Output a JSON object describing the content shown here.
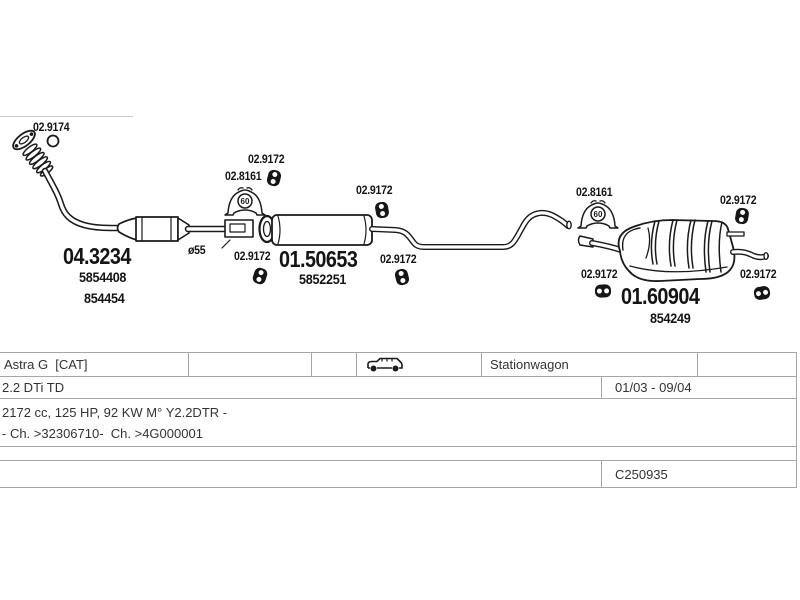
{
  "diagram": {
    "gasket_label": "02.9174",
    "hanger_label": "02.9172",
    "bracket_label": "02.8161",
    "bracket_size": "60",
    "front_pipe": {
      "number": "04.3234",
      "ref1": "5854408",
      "ref2": "854454",
      "diameter_note": "ø55"
    },
    "middle_silencer": {
      "number": "01.50653",
      "ref1": "5852251"
    },
    "rear_silencer": {
      "number": "01.60904",
      "ref1": "854249"
    },
    "icons": {
      "hanger": "rubber-hanger-icon",
      "bracket": "mounting-bracket-icon",
      "gasket": "o-ring-icon"
    }
  },
  "info_table": {
    "model": "Astra G  [CAT]",
    "body_type": "Stationwagon",
    "engine": "2.2 DTi TD",
    "build_period": "01/03 - 09/04",
    "spec_line1": "2172 cc, 125 HP, 92 KW M° Y2.2DTR -",
    "spec_line2": "- Ch. >32306710-  Ch. >4G000001",
    "document_code": "C250935",
    "car_icon": "stationwagon-icon"
  },
  "colors": {
    "line_art": "#1a1a1a",
    "table_border": "#a6a6a6",
    "table_text": "#333333"
  }
}
